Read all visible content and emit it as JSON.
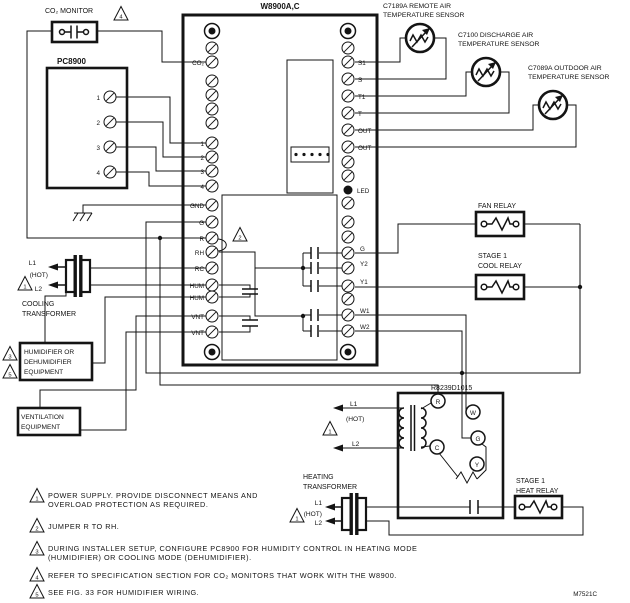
{
  "diagram": {
    "drawing_number": "M7521C",
    "w8900": {
      "title": "W8900A,C",
      "led_label": "LED",
      "left_terminals": {
        "co2": "CO₂",
        "t1": "1",
        "t2": "2",
        "t3": "3",
        "t4": "4",
        "gnd": "GND",
        "g": "G",
        "r": "R",
        "rh": "RH",
        "rc": "RC",
        "hum1": "HUM",
        "hum2": "HUM",
        "vnt1": "VNT",
        "vnt2": "VNT"
      },
      "right_terminals": {
        "s1": "S1",
        "s": "S",
        "t1": "T1",
        "t": "T",
        "out1": "OUT",
        "out2": "OUT",
        "g": "G",
        "y2": "Y2",
        "y1": "Y1",
        "w1": "W1",
        "w2": "W2"
      }
    },
    "co2_monitor": {
      "label": "CO₂ MONITOR"
    },
    "pc8900": {
      "title": "PC8900",
      "terminals": [
        "1",
        "2",
        "3",
        "4"
      ]
    },
    "sensors": {
      "remote": {
        "line1": "C7189A REMOTE AIR",
        "line2": "TEMPERATURE SENSOR"
      },
      "discharge": {
        "line1": "C7100 DISCHARGE AIR",
        "line2": "TEMPERATURE SENSOR"
      },
      "outdoor": {
        "line1": "C7089A OUTDOOR AIR",
        "line2": "TEMPERATURE SENSOR"
      }
    },
    "relays": {
      "fan": {
        "line1": "FAN RELAY"
      },
      "cool": {
        "line1": "STAGE 1",
        "line2": "COOL RELAY"
      },
      "heat": {
        "line1": "STAGE 1",
        "line2": "HEAT RELAY"
      }
    },
    "cooling_transformer": {
      "l1": "L1",
      "hot": "(HOT)",
      "l2": "L2",
      "line1": "COOLING",
      "line2": "TRANSFORMER"
    },
    "heating_transformer": {
      "l1": "L1",
      "hot": "(HOT)",
      "l2": "L2",
      "line1": "HEATING",
      "line2": "TRANSFORMER"
    },
    "r8239": {
      "label": "R8239D1015",
      "l1": "L1",
      "hot": "(HOT)",
      "l2": "L2",
      "terminals": {
        "r": "R",
        "c": "C",
        "w": "W",
        "g": "G",
        "y": "Y"
      }
    },
    "humidifier_box": {
      "line1": "HUMIDIFIER OR",
      "line2": "DEHUMIDIFIER",
      "line3": "EQUIPMENT"
    },
    "ventilation_box": {
      "line1": "VENTILATION",
      "line2": "EQUIPMENT"
    },
    "warn_numbers": {
      "n1": "1",
      "n2": "2",
      "n3": "3",
      "n4": "4",
      "n5": "5"
    },
    "notes": [
      {
        "num": "1",
        "line1": "POWER SUPPLY. PROVIDE DISCONNECT MEANS AND",
        "line2": "OVERLOAD PROTECTION AS REQUIRED."
      },
      {
        "num": "2",
        "line1": "JUMPER R TO RH."
      },
      {
        "num": "3",
        "line1": "DURING INSTALLER SETUP, CONFIGURE PC8900 FOR HUMIDITY CONTROL IN HEATING MODE",
        "line2": "(HUMIDIFIER) OR COOLING MODE (DEHUMIDIFIER)."
      },
      {
        "num": "4",
        "line1": "REFER TO SPECIFICATION SECTION FOR CO₂ MONITORS THAT WORK WITH THE W8900."
      },
      {
        "num": "5",
        "line1": "SEE FIG. 33 FOR HUMIDIFIER WIRING."
      }
    ]
  }
}
